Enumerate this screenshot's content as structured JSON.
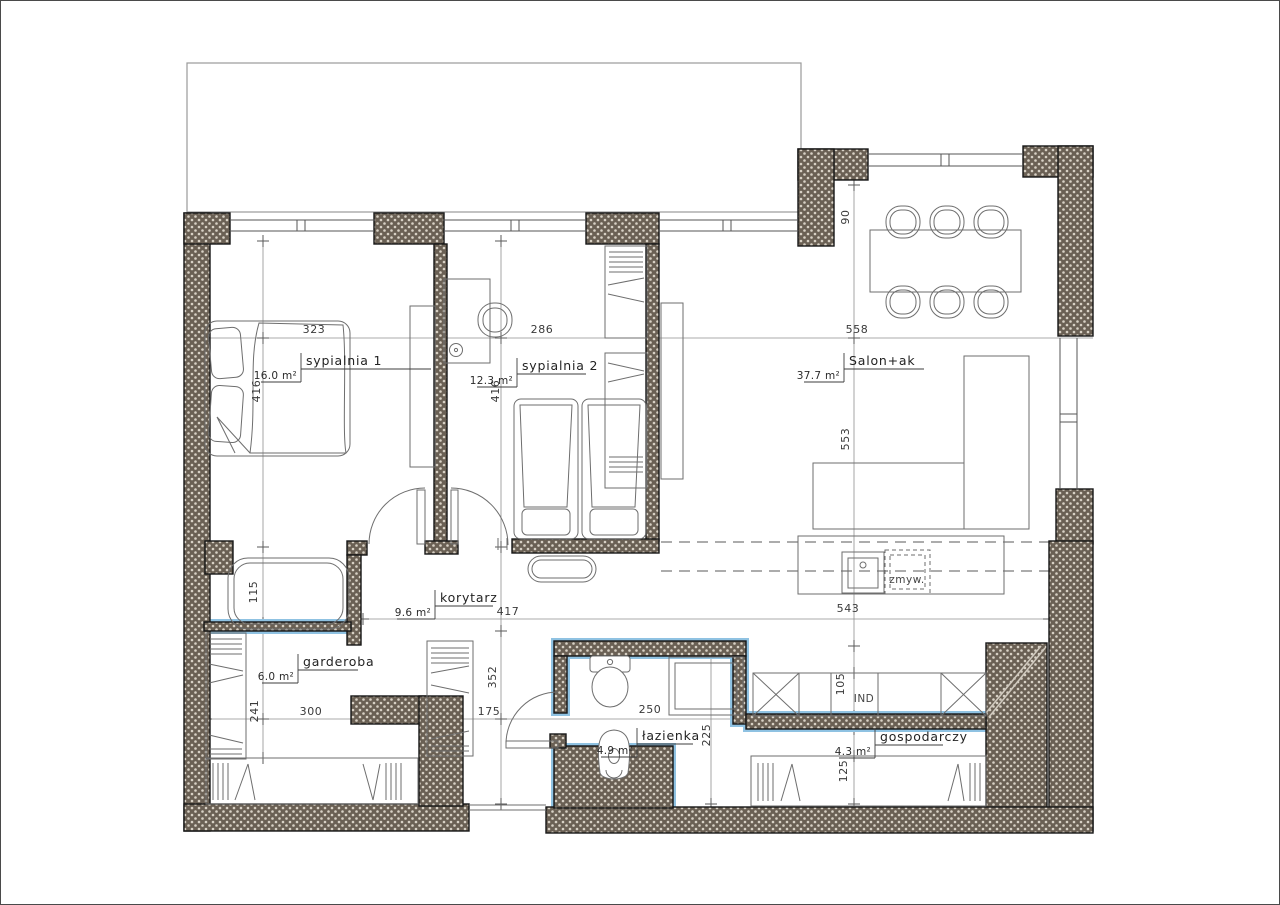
{
  "plan": {
    "type": "apartment-floor-plan",
    "language": "Polish"
  },
  "rooms": [
    {
      "name": "sypialnia  1",
      "area": "16.0 m²"
    },
    {
      "name": "sypialnia  2",
      "area": "12.3 m²"
    },
    {
      "name": "Salon+ak",
      "area": "37.7 m²"
    },
    {
      "name": "korytarz",
      "area": "9.6 m²"
    },
    {
      "name": "garderoba",
      "area": "6.0 m²"
    },
    {
      "name": "łazienka",
      "area": "4.9 m²"
    },
    {
      "name": "gospodarczy",
      "area": "4.3 m²"
    }
  ],
  "fixtures": {
    "dishwasher": "zmyw.",
    "induction_hob": "IND"
  },
  "dims": {
    "top": {
      "bedroom1": "323",
      "bedroom2": "286",
      "salon": "558"
    },
    "side": {
      "bedroom1": "416",
      "bedroom2": "416",
      "dining": "90",
      "salon": "553",
      "tub_niche": "115",
      "garderoba": "241",
      "vestibule": "352",
      "bathroom": "225",
      "kitchen_row": "105",
      "gospodarczy": "125"
    },
    "bottom": {
      "garderoba": "300",
      "vestibule": "175",
      "bathroom": "250",
      "corridor": "417",
      "salon": "543"
    }
  },
  "colors": {
    "wall_fill": "#6a6054",
    "wall_dots": "#d8d1c5",
    "wall_outline": "#161616",
    "blue_glass": "#8fc2e2",
    "thin_line": "#6e6e6e",
    "dim_line": "#8f8f8f"
  }
}
